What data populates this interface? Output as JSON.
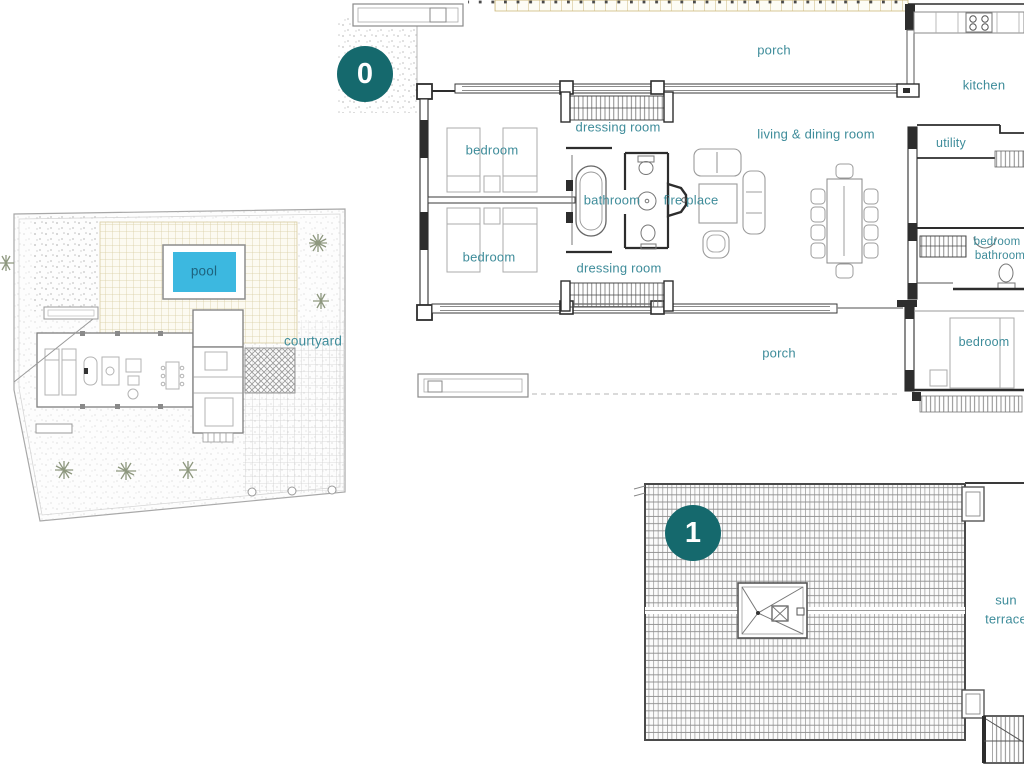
{
  "document": {
    "type": "architectural floor plan drawing",
    "background": "#ffffff"
  },
  "palette": {
    "label_teal": "#3e8c9a",
    "pool_label_color": "#1e637e",
    "badge_background": "#15696d",
    "badge_text_color": "#ffffff",
    "pool_water": "#3cb8e0",
    "beige_tile_line": "#d8cda2",
    "gray_tile_line": "#cfcfcf",
    "roof_hatch_line": "#8d8d8d",
    "wall_color": "#2d2d2d"
  },
  "site_plan": {
    "labels": {
      "pool": "pool",
      "courtyard": "courtyard"
    }
  },
  "level_0": {
    "badge": "0",
    "labels": {
      "porch_top": "porch",
      "dressing_room_top": "dressing room",
      "bedroom_top": "bedroom",
      "bedroom_bottom": "bedroom",
      "bathroom": "bathroom",
      "fire_place": "fire place",
      "living_dining_room": "living & dining room",
      "kitchen": "kitchen",
      "utility": "utility",
      "bedroom_right": "bedroom",
      "bathroom_right": "bathroom",
      "bedroom_bottom_right": "bedroom",
      "dressing_room_bottom": "dressing room",
      "porch_bottom": "porch"
    }
  },
  "level_1": {
    "badge": "1",
    "labels": {
      "sun_terrace_line1": "sun",
      "sun_terrace_line2": "terrace"
    }
  }
}
